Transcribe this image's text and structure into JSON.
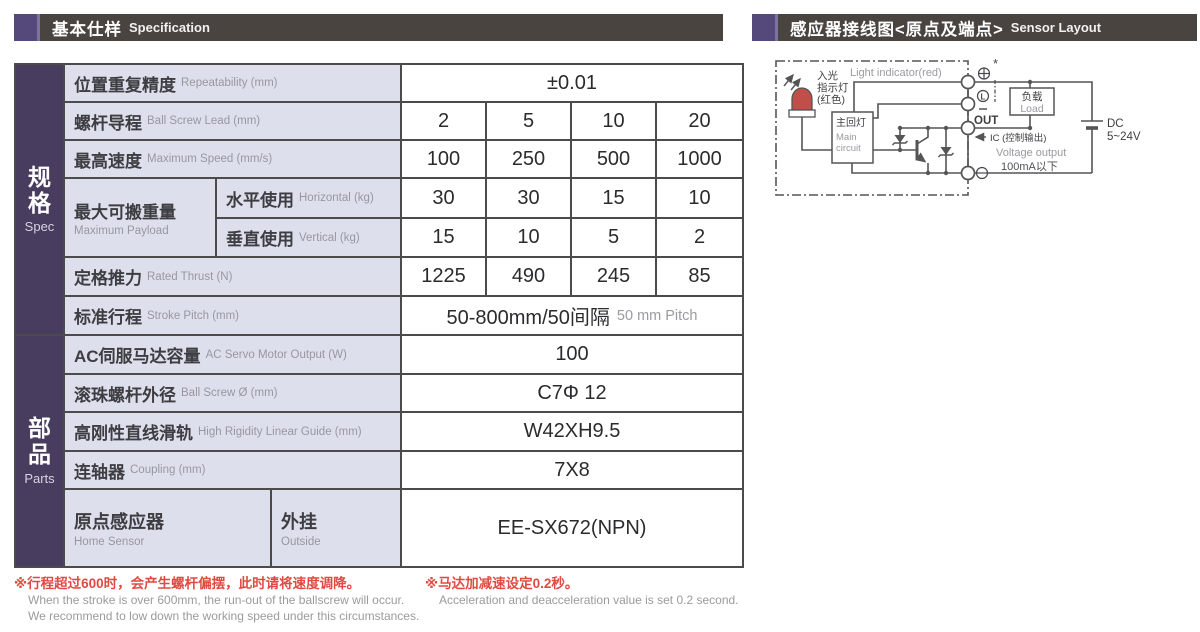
{
  "colors": {
    "accent_purple": "#483c5f",
    "header_bar": "#4a4441",
    "header_square": "#55497b",
    "label_bg": "#dde0ec",
    "note_red": "#e04a40",
    "note_gray": "#9b9b9b",
    "led_red": "#bf4f48"
  },
  "left_header": {
    "title_zh": "基本仕样",
    "title_en": "Specification"
  },
  "right_header": {
    "title_zh": "感应器接线图<原点及端点>",
    "title_en": "Sensor Layout"
  },
  "table": {
    "sidebar": {
      "spec": {
        "zh": "规格",
        "en": "Spec"
      },
      "parts": {
        "zh": "部品",
        "en": "Parts"
      }
    },
    "rows": {
      "repeatability": {
        "zh": "位置重复精度",
        "en": "Repeatability (mm)",
        "value": "±0.01"
      },
      "ball_screw_lead": {
        "zh": "螺杆导程",
        "en": "Ball Screw Lead (mm)",
        "values": [
          "2",
          "5",
          "10",
          "20"
        ]
      },
      "max_speed": {
        "zh": "最高速度",
        "en": "Maximum Speed (mm/s)",
        "values": [
          "100",
          "250",
          "500",
          "1000"
        ]
      },
      "max_payload": {
        "zh": "最大可搬重量",
        "en": "Maximum Payload",
        "horizontal": {
          "zh": "水平使用",
          "en": "Horizontal (kg)",
          "values": [
            "30",
            "30",
            "15",
            "10"
          ]
        },
        "vertical": {
          "zh": "垂直使用",
          "en": "Vertical (kg)",
          "values": [
            "15",
            "10",
            "5",
            "2"
          ]
        }
      },
      "rated_thrust": {
        "zh": "定格推力",
        "en": "Rated Thrust (N)",
        "values": [
          "1225",
          "490",
          "245",
          "85"
        ]
      },
      "stroke": {
        "zh": "标准行程",
        "en": "Stroke Pitch (mm)",
        "value_zh": "50-800mm/50间隔",
        "value_en": "50 mm Pitch"
      },
      "servo_output": {
        "zh": "AC伺服马达容量",
        "en": "AC Servo Motor Output (W)",
        "value": "100"
      },
      "ball_screw_dia": {
        "zh": "滚珠螺杆外径",
        "en": "Ball Screw Ø (mm)",
        "value": "C7Φ 12"
      },
      "linear_guide": {
        "zh": "高刚性直线滑轨",
        "en": "High Rigidity Linear Guide (mm)",
        "value": "W42XH9.5"
      },
      "coupling": {
        "zh": "连轴器",
        "en": "Coupling (mm)",
        "value": "7X8"
      },
      "home_sensor": {
        "zh": "原点感应器",
        "en": "Home Sensor",
        "sub_zh": "外挂",
        "sub_en": "Outside",
        "value": "EE-SX672(NPN)"
      }
    }
  },
  "notes": {
    "note1_zh": "※行程超过600时，会产生螺杆偏摆，此时请将速度调降。",
    "note1_en1": "When the stroke is over 600mm, the run-out of the ballscrew will occur.",
    "note1_en2": "We recommend to low down the working speed under this circumstances.",
    "note2_zh": "※马达加减速设定0.2秒。",
    "note2_en": "Acceleration and deacceleration value is set 0.2 second."
  },
  "diagram": {
    "light_indicator_en": "Light indicator(red)",
    "light_zh1": "入光",
    "light_zh2": "指示灯",
    "light_zh3": "(红色)",
    "main_circuit_zh": "主回灯",
    "main_circuit_en1": "Main",
    "main_circuit_en2": "circuit",
    "asterisk": "*",
    "terminal_l_letter": "L",
    "terminal_out": "OUT",
    "ic_label": "IC (控制输出)",
    "voltage_output": "Voltage output",
    "current_limit": "100mA以下",
    "load_zh": "负载",
    "load_en": "Load",
    "dc_line1": "DC",
    "dc_line2": "5~24V"
  }
}
